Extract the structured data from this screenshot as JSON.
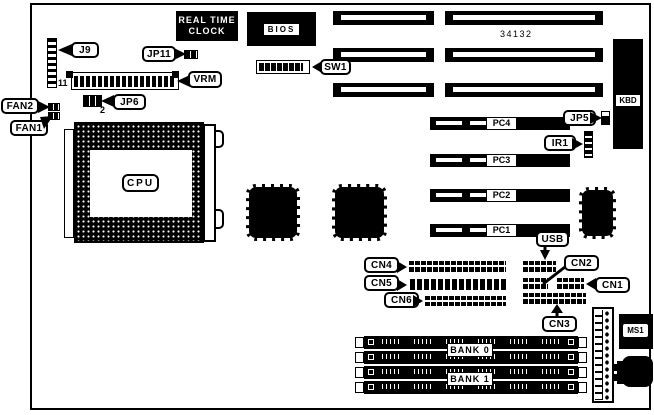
{
  "board": {
    "part_number": "34132",
    "chips": {
      "rtc_line1": "REAL TIME",
      "rtc_line2": "CLOCK",
      "bios": "BIOS",
      "cpu": "CPU",
      "kbd": "KBD",
      "ms1": "MS1"
    },
    "switches": {
      "sw1": "SW1"
    },
    "jumpers": {
      "j9": "J9",
      "jp11": "JP11",
      "jp6": "JP6",
      "jp5": "JP5",
      "ir1": "IR1"
    },
    "modules": {
      "vrm": "VRM"
    },
    "fans": {
      "fan1": "FAN1",
      "fan2": "FAN2"
    },
    "slots": {
      "pc1": "PC1",
      "pc2": "PC2",
      "pc3": "PC3",
      "pc4": "PC4"
    },
    "connectors": {
      "usb": "USB",
      "cn1": "CN1",
      "cn2": "CN2",
      "cn3": "CN3",
      "cn4": "CN4",
      "cn5": "CN5",
      "cn6": "CN6"
    },
    "memory": {
      "bank0": "BANK 0",
      "bank1": "BANK 1"
    },
    "pin_markers": {
      "j9_pin": "11",
      "jp6_pin": "2"
    }
  }
}
